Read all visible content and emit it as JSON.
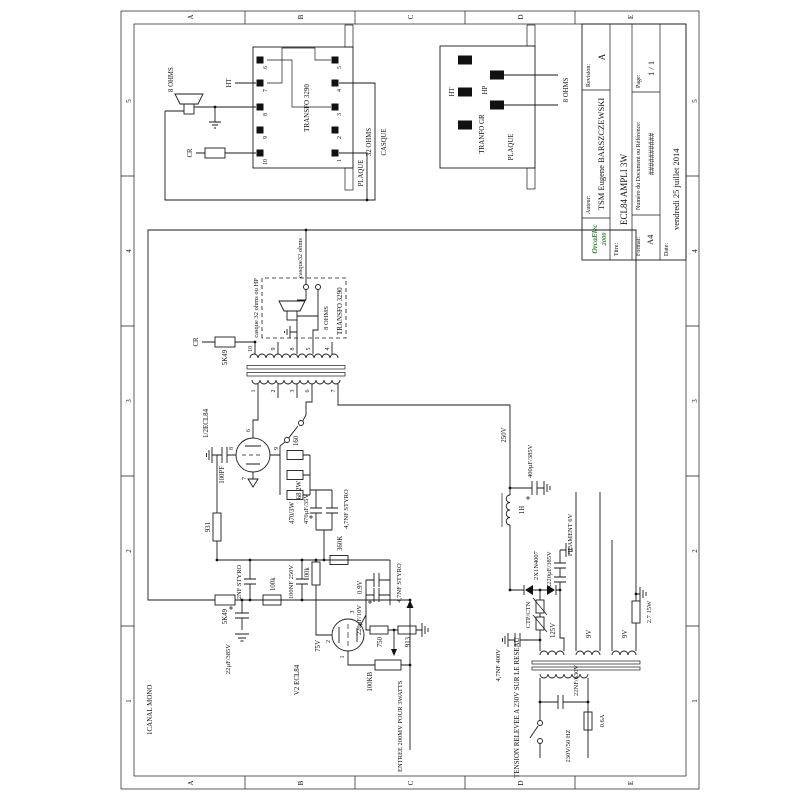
{
  "frame": {
    "letters": [
      "A",
      "B",
      "C",
      "D",
      "E"
    ],
    "numbers": [
      "1",
      "2",
      "3",
      "4",
      "5"
    ]
  },
  "title_block": {
    "logo_line1": "OrcaElec",
    "logo_line2": "2000",
    "auteur_label": "Auteur:",
    "auteur": "TSM Eugene BARSZCZEWSKI",
    "revision_label": "Revision:",
    "revision": "A",
    "titre_label": "Titre:",
    "titre": "ECL84 AMPLI 3W",
    "format_label": "Format:",
    "format": "A4",
    "numero_label": "Numéro du Document ou Référence:",
    "numero": "##########",
    "date_label": "Date:",
    "date": "vendredi 25 juillet 2014",
    "page_label": "Page:",
    "page": "1 / 1"
  },
  "output_transfo": {
    "name": "TRANSFO 3290",
    "top_pins": [
      "10",
      "9",
      "8",
      "7",
      "6"
    ],
    "bottom_pins": [
      "1",
      "2",
      "3",
      "4",
      "5"
    ],
    "ht": "HT",
    "ohms8": "8 OHMS",
    "cr": "CR",
    "ohms32": "32 OHMS",
    "casque": "CASQUE",
    "plaque": "PLAQUE"
  },
  "transfo_gr": {
    "name": "TRANFO GR",
    "ht": "HT",
    "hp": "HP",
    "plaque": "PLAQUE",
    "ohms8": "8 OHMS"
  },
  "mid_transfo": {
    "name": "TRANSFO 3290",
    "sec_pins": [
      "10",
      "9",
      "8",
      "5",
      "4"
    ],
    "pri_pins": [
      "1",
      "2",
      "3",
      "6",
      "7"
    ],
    "dashed_label": "casque 32 ohms ou HP",
    "wire_label": "casque32 ohms",
    "ohms8": "8 OHMS",
    "cr": "CR",
    "r_feedback": "5K49"
  },
  "v1": {
    "name": "1/2ECL84",
    "pin_anode": "6",
    "pin_grid": "8",
    "pin_screen": "9",
    "pin_cathode": "7",
    "c_grid": "100PF",
    "r_grid": "931",
    "r_screen": "160",
    "r_68": "68 2W",
    "r_470": "470/3W",
    "c_bypass_el": "470µF/35V",
    "c_bypass_styro": "4,7NF STYRO",
    "r_360k": "360K"
  },
  "v2": {
    "name": "V2 ECL84",
    "pin_anode": "2",
    "pin_cathode": "3",
    "pin_grid": "1",
    "v_anode": "75V",
    "v_cathode": "0.9V",
    "r_load": "100k",
    "r_cath1": "750",
    "r_cath2": "913",
    "c_cath_el": "220µF/10V",
    "c_cath_styro": "4,7NF STYRO",
    "pot": "100KB"
  },
  "input": {
    "c_2nf": "2NF STYRO",
    "c_100nf": "100NF 250V",
    "r_100k": "100k",
    "r_5k49": "5K49",
    "c_22uf": "22µF/385V",
    "entree": "ENTREE 200MV POUR 3WATTS"
  },
  "psu": {
    "v_b": "250V",
    "c_400": "400µF/385V",
    "choke": "1H",
    "filament": "FILAMENT 6V",
    "c_47nf": "4,7NF 400V",
    "diodes": "2X1N4007",
    "c_2x220": "2X220µF/385V",
    "ctp": "CTP/CTN",
    "v125": "125V",
    "v9a": "9V",
    "v9b": "9V",
    "r_27": "2.7 15W",
    "mains_note": "TENSION RELEVEE A 230V SUR LE RESEAU",
    "mains": "230V/50 HZ",
    "c_22nf": "22NF/630V",
    "fuse": "0.6A"
  },
  "misc": {
    "canal": "1CANAL MONO"
  }
}
